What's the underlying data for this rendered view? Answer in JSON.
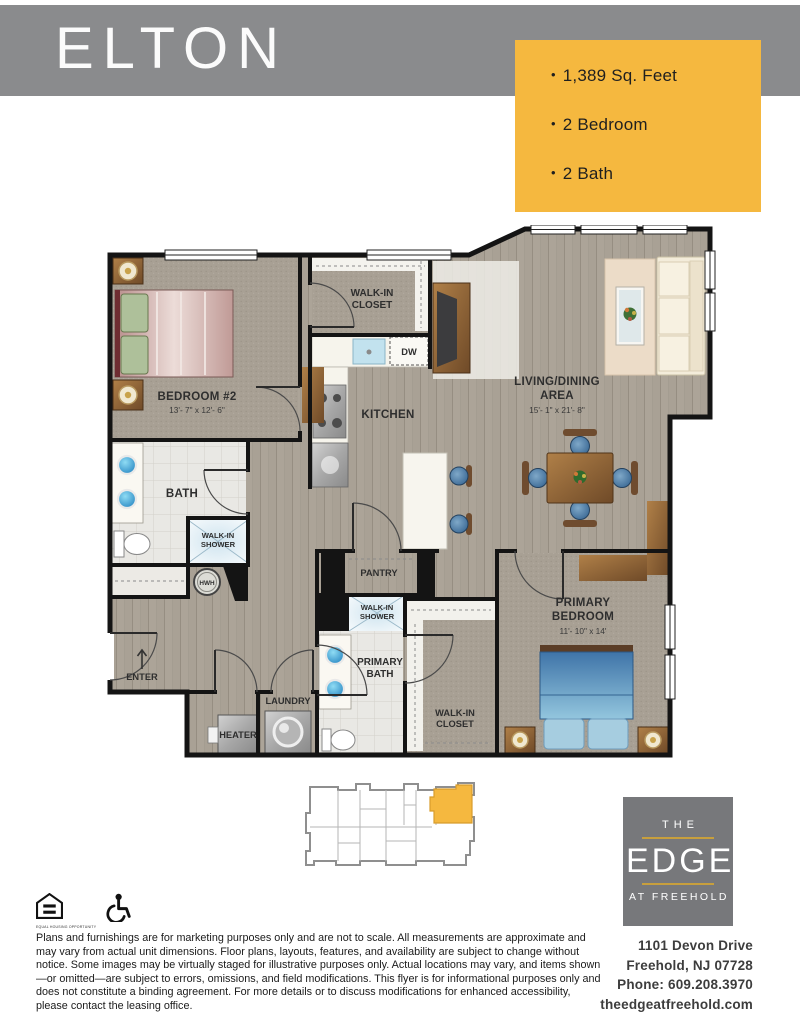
{
  "banner": {
    "title": "ELTON",
    "bg_color": "#8a8b8d",
    "text_color": "#fbfbfb"
  },
  "info_box": {
    "bg_color": "#F5B83F",
    "items": [
      "1,389 Sq. Feet",
      "2 Bedroom",
      "2 Bath"
    ]
  },
  "floor_plan": {
    "bedroom2": {
      "name": "BEDROOM #2",
      "dims": "13'- 7\" x 12'- 6\""
    },
    "bath": {
      "name": "BATH"
    },
    "shower2": {
      "line1": "WALK-IN",
      "line2": "SHOWER"
    },
    "hwh": "HWH",
    "closet_top": {
      "line1": "WALK-IN",
      "line2": "CLOSET"
    },
    "kitchen": "KITCHEN",
    "dw": "DW",
    "living": {
      "line1": "LIVING/DINING",
      "line2": "AREA",
      "dims": "15'- 1\" x 21'- 8\""
    },
    "pantry": "PANTRY",
    "shower_primary": {
      "line1": "WALK-IN",
      "line2": "SHOWER"
    },
    "primary_bath": {
      "line1": "PRIMARY",
      "line2": "BATH"
    },
    "closet_primary": {
      "line1": "WALK-IN",
      "line2": "CLOSET"
    },
    "primary_bedroom": {
      "line1": "PRIMARY",
      "line2": "BEDROOM",
      "dims": "11'- 10\" x 14'"
    },
    "laundry": "LAUNDRY",
    "heater": "HEATER",
    "enter": "ENTER"
  },
  "site_plan": {
    "highlight_color": "#F5B83F",
    "outline_color": "#8f8f8f"
  },
  "logo": {
    "the": "THE",
    "edge": "EDGE",
    "at_freehold": "AT FREEHOLD",
    "bg_color": "#77787b",
    "accent_color": "#c79f3d"
  },
  "contact": {
    "address1": "1101 Devon Drive",
    "address2": "Freehold, NJ 07728",
    "phone": "Phone: 609.208.3970",
    "website": "theedgeatfreehold.com"
  },
  "icons": {
    "equal_housing_caption": "EQUAL HOUSING OPPORTUNITY"
  },
  "disclaimer": "Plans and furnishings are for marketing purposes only and are not to scale. All measurements are approximate and may vary from actual unit dimensions. Floor plans, layouts, features, and availability are subject to change without notice. Some images may be virtually staged for illustrative purposes only. Actual locations may vary, and items shown—or omitted—are subject to errors, omissions, and field modifications. This flyer is for informational purposes only and does not constitute a binding agreement. For more details or to discuss modifications for enhanced accessibility, please contact the leasing office."
}
